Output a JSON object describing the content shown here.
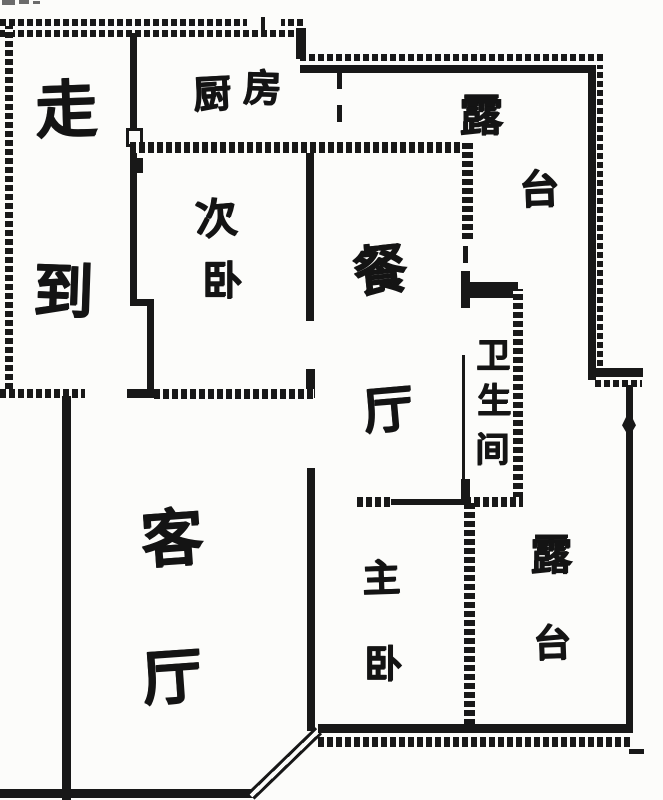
{
  "plan": {
    "ink_color": "#181818",
    "background_color": "#fcfcfa"
  },
  "rooms": {
    "corridor": {
      "label": "走到",
      "chars": [
        "走",
        "到"
      ]
    },
    "kitchen": {
      "label": "厨房",
      "chars": [
        "厨",
        "房"
      ]
    },
    "terrace_upper": {
      "label": "露台",
      "chars": [
        "露",
        "台"
      ]
    },
    "secondary_bedroom": {
      "label": "次卧",
      "chars": [
        "次",
        "卧"
      ]
    },
    "dining_room": {
      "label": "餐厅",
      "chars": [
        "餐",
        "厅"
      ]
    },
    "bathroom": {
      "label": "卫生间",
      "chars": [
        "卫",
        "生",
        "间"
      ]
    },
    "living_room": {
      "label": "客厅",
      "chars": [
        "客",
        "厅"
      ]
    },
    "master_bedroom": {
      "label": "主卧",
      "chars": [
        "主",
        "卧"
      ]
    },
    "terrace_lower": {
      "label": "露台",
      "chars": [
        "露",
        "台"
      ]
    }
  }
}
